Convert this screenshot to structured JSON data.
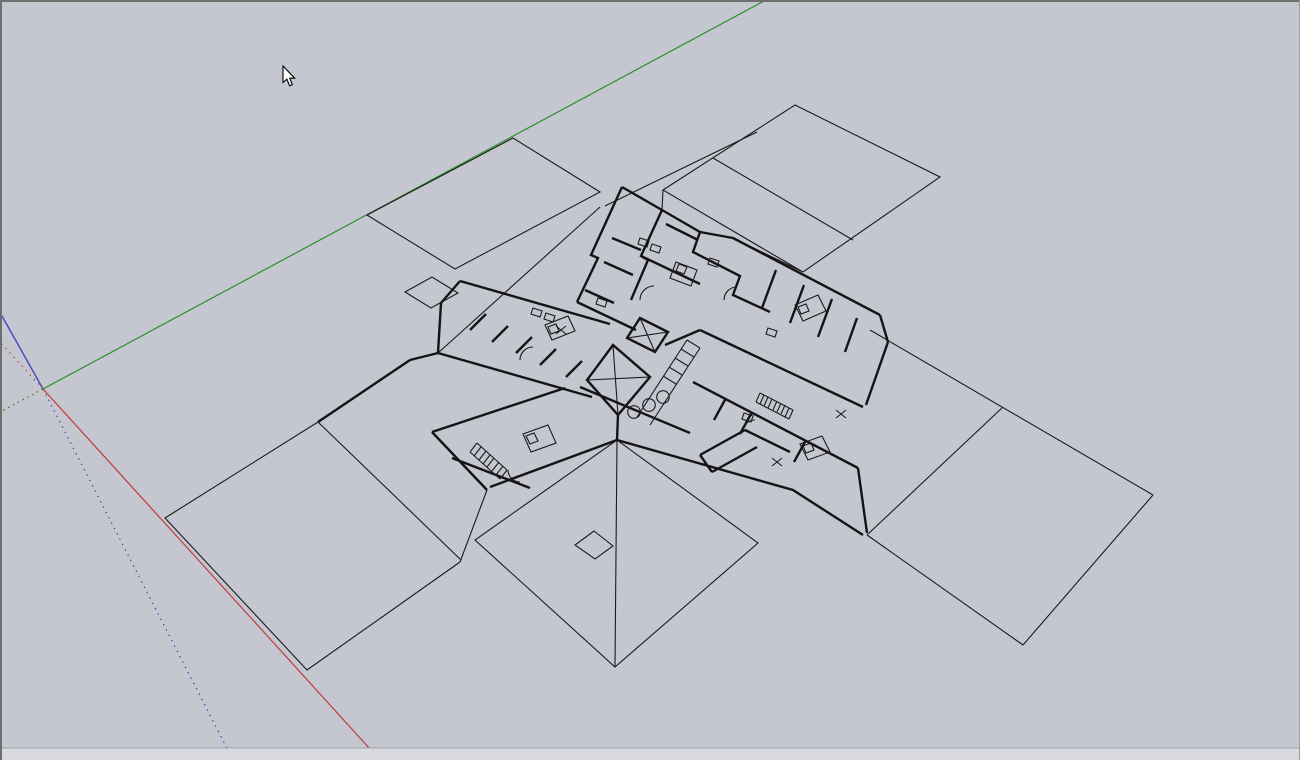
{
  "app": {
    "name": "3D modeling viewport",
    "description": "Perspective wireframe view of a cross-shaped building floor plan with flat roof planes, a pyramidal hip roof, drawing axes and an arrow cursor"
  },
  "viewport": {
    "width": 1300,
    "height": 760,
    "background_color": "#c5c7d0",
    "top_border_color": "#6e6e6e",
    "left_border_color": "#6e6e6e",
    "right_border_color": "#9b9da6",
    "bottom_strip_color": "#d8dae0",
    "bottom_strip_edge_color": "#a0a2ab"
  },
  "drawing": {
    "line_color": "#1b1b1b",
    "wall_line_color": "#141414",
    "wall_stroke_width": 2.4,
    "detail_stroke_width": 1.1
  },
  "axes": {
    "origin_x": 43,
    "origin_y": 389,
    "green_axis": {
      "color": "#2f8f2f",
      "x1": 766,
      "y1": 0,
      "x2": 43,
      "y2": 389,
      "dash_x2": 0,
      "dash_y2": 412
    },
    "red_axis": {
      "color": "#c03a36",
      "x1": 43,
      "y1": 389,
      "x2": 380,
      "y2": 760,
      "dash_x2": 0,
      "dash_y2": 342
    },
    "blue_axis": {
      "color": "#4348b5",
      "x1": 2,
      "y1": 316,
      "x2": 43,
      "y2": 389,
      "dash_x2": 233,
      "dash_y2": 760
    }
  },
  "cursor": {
    "type": "arrow",
    "x": 283,
    "y": 66,
    "transform": "translate(283,66)"
  },
  "scene": {
    "elements": [
      "roof-plane-top-left",
      "roof-plane-top-right",
      "roof-plane-right",
      "roof-plane-bottom-left",
      "pyramid-hip-roof",
      "roof-hatch-opening",
      "detached-annex-square",
      "floor-plan-walls",
      "elevator-core-x",
      "central-corridor",
      "corridor-columns",
      "staircases",
      "beds",
      "door-swings",
      "bath-fixtures"
    ]
  }
}
